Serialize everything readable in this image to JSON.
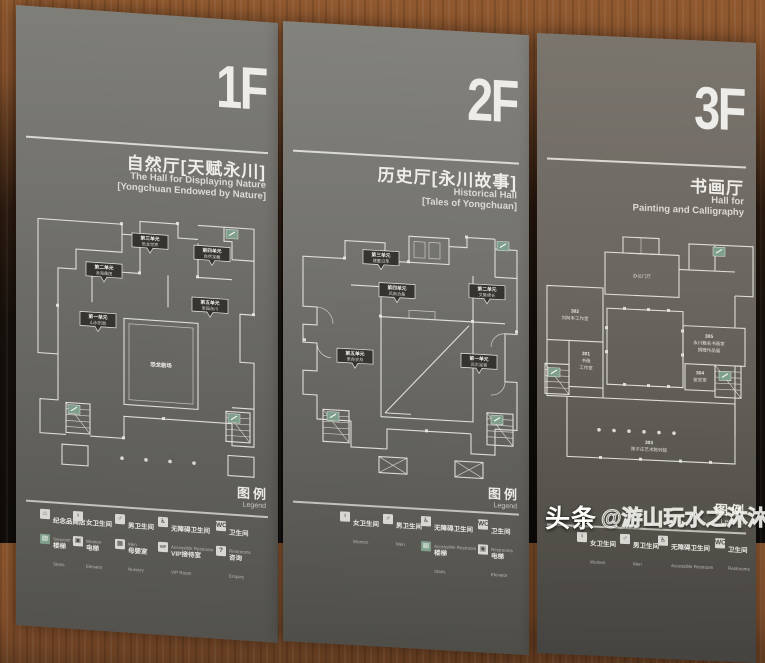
{
  "watermark": {
    "brand": "头条",
    "handle": "@游山玩水之沐沐"
  },
  "colors": {
    "panel_gray": "#6f6e69",
    "wood": "#86512c",
    "plan_line": "#eae8e3",
    "exit_green": "#7f9f8c"
  },
  "panels": [
    {
      "floor": "1F",
      "title_cn": "自然厅[天赋永川]",
      "title_en1": "The Hall for Displaying Nature",
      "title_en2": "[Yongchuan Endowed by Nature]",
      "center_room": "恐龙剧场",
      "units": [
        {
          "unit": "第一单元",
          "name": "山水形胜"
        },
        {
          "unit": "第二单元",
          "name": "沧海桑田"
        },
        {
          "unit": "第三单元",
          "name": "恐龙世界"
        },
        {
          "unit": "第四单元",
          "name": "自然宝藏"
        },
        {
          "unit": "第五单元",
          "name": "家园永川"
        }
      ],
      "legend_cn": "图例",
      "legend_en": "Legend",
      "legend_rows": [
        [
          {
            "glyph": "⌂",
            "cn": "纪念品商店",
            "en": "Souvenir Store"
          },
          {
            "glyph": "♀",
            "cn": "女卫生间",
            "en": "Women"
          },
          {
            "glyph": "♂",
            "cn": "男卫生间",
            "en": "Men"
          },
          {
            "glyph": "♿",
            "cn": "无障碍卫生间",
            "en": "Accessible Restroom"
          },
          {
            "glyph": "WC",
            "cn": "卫生间",
            "en": "Restrooms"
          }
        ],
        [
          {
            "glyph": "▤",
            "cn": "楼梯",
            "en": "Stairs"
          },
          {
            "glyph": "▣",
            "cn": "电梯",
            "en": "Elevator"
          },
          {
            "glyph": "▦",
            "cn": "母婴室",
            "en": "Nursery"
          },
          {
            "glyph": "VIP",
            "cn": "VIP接待室",
            "en": "VIP Room"
          },
          {
            "glyph": "?",
            "cn": "咨询",
            "en": "Enquiry"
          }
        ]
      ]
    },
    {
      "floor": "2F",
      "title_cn": "历史厅[永川故事]",
      "title_en1": "Historical Hall",
      "title_en2": "[Tales of Yongchuan]",
      "units": [
        {
          "unit": "第一单元",
          "name": "远古足音"
        },
        {
          "unit": "第二单元",
          "name": "文脉绵长"
        },
        {
          "unit": "第三单元",
          "name": "建置沿革"
        },
        {
          "unit": "第四单元",
          "name": "风雨沧桑"
        },
        {
          "unit": "第五单元",
          "name": "革命岁月"
        }
      ],
      "legend_cn": "图例",
      "legend_en": "Legend",
      "legend_rows": [
        [
          {
            "glyph": "♀",
            "cn": "女卫生间",
            "en": "Women"
          },
          {
            "glyph": "♂",
            "cn": "男卫生间",
            "en": "Men"
          },
          {
            "glyph": "♿",
            "cn": "无障碍卫生间",
            "en": "Accessible Restroom"
          },
          {
            "glyph": "WC",
            "cn": "卫生间",
            "en": "Restrooms"
          }
        ],
        [
          {
            "glyph": "▤",
            "cn": "楼梯",
            "en": "Stairs"
          },
          {
            "glyph": "▣",
            "cn": "电梯",
            "en": "Elevator"
          }
        ]
      ]
    },
    {
      "floor": "3F",
      "title_cn": "书画厅",
      "title_en1": "Hall for",
      "title_en2": "Painting and Calligraphy",
      "rooms": {
        "office": "办公门厅",
        "r302": [
          "302",
          "刘阿本工作室"
        ],
        "r301": [
          "301",
          "书画",
          "工作室"
        ],
        "r305": [
          "305",
          "永川籍名书画家",
          "捐赠作品展"
        ],
        "r304": [
          "304",
          "鉴定室"
        ],
        "r303": [
          "303",
          "陈子庄艺术陈列馆"
        ]
      },
      "legend_cn": "图例",
      "legend_en": "Legend",
      "legend_rows": [
        [
          {
            "glyph": "♀",
            "cn": "女卫生间",
            "en": "Women"
          },
          {
            "glyph": "♂",
            "cn": "男卫生间",
            "en": "Men"
          },
          {
            "glyph": "♿",
            "cn": "无障碍卫生间",
            "en": "Accessible Restroom"
          },
          {
            "glyph": "WC",
            "cn": "卫生间",
            "en": "Restrooms"
          }
        ]
      ]
    }
  ]
}
